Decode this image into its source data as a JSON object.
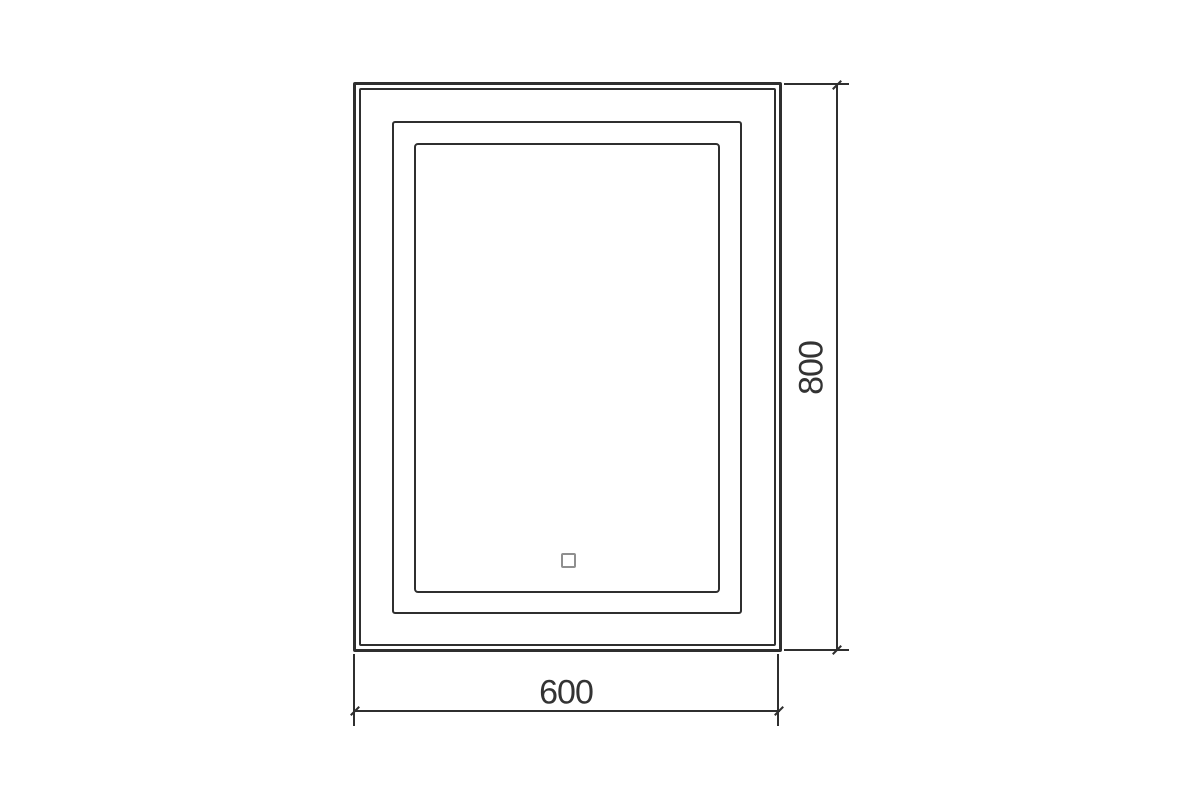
{
  "colors": {
    "background": "#ffffff",
    "line": "#2f2f2f",
    "text": "#333333",
    "touch_sensor": "#8f8f8f"
  },
  "dimensions": {
    "width": {
      "label": "600"
    },
    "height": {
      "label": "800"
    }
  }
}
